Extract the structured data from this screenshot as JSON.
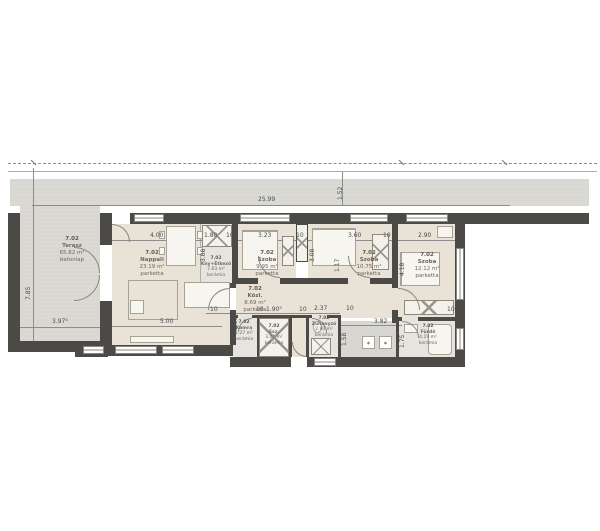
{
  "plan": {
    "unit": "7.02",
    "rooms": [
      {
        "id": "terasz",
        "number": "7.02",
        "name": "Terasz",
        "area": "65.82 m²",
        "floor": "betonlap"
      },
      {
        "id": "nappali",
        "number": "7.02",
        "name": "Nappali",
        "area": "23.19 m²",
        "floor": "parketta"
      },
      {
        "id": "kny",
        "number": "7.02",
        "name": "Kny+Étkező",
        "area": "7.63 m²",
        "floor": "kerámia"
      },
      {
        "id": "szoba1",
        "number": "7.02",
        "name": "Szoba",
        "area": "9.95 m²",
        "floor": "parketta"
      },
      {
        "id": "szoba2",
        "number": "7.02",
        "name": "Szoba",
        "area": "10.75 m²",
        "floor": "parketta"
      },
      {
        "id": "szoba3",
        "number": "7.02",
        "name": "Szoba",
        "area": "12.12 m²",
        "floor": "parketta"
      },
      {
        "id": "kozl",
        "number": "7.02",
        "name": "Közl.",
        "area": "8.69 m²",
        "floor": "parketta"
      },
      {
        "id": "kamra",
        "number": "7.02",
        "name": "Kamra",
        "area": "1.27 m²",
        "floor": "kerámia"
      },
      {
        "id": "esz",
        "number": "7.02",
        "name": "Esz.",
        "area": "3.01 m²",
        "floor": "kerámia"
      },
      {
        "id": "zuhanyzo",
        "number": "7.02",
        "name": "Zuhanyzó",
        "area": "2.90 m²",
        "floor": "kerámia"
      },
      {
        "id": "furdo",
        "number": "7.02",
        "name": "Fürdő",
        "area": "4.19 m²",
        "floor": "kerámia"
      }
    ],
    "dimensions": [
      {
        "id": "total-width",
        "text": "25.99"
      },
      {
        "id": "band-depth",
        "text": "1.52"
      },
      {
        "id": "terrace-depth",
        "text": "7.85"
      },
      {
        "id": "terrace-width",
        "text": "3.97⁵"
      },
      {
        "id": "nappali-width",
        "text": "4.00"
      },
      {
        "id": "kny-width",
        "text": "1.80"
      },
      {
        "id": "wall-10-a",
        "text": "10"
      },
      {
        "id": "szoba1-width",
        "text": "3.23"
      },
      {
        "id": "wall-10-b",
        "text": "10"
      },
      {
        "id": "szoba2-width",
        "text": "3.60"
      },
      {
        "id": "wall-10-c",
        "text": "10"
      },
      {
        "id": "szoba3-width",
        "text": "2.90"
      },
      {
        "id": "kny-depth",
        "text": "3.08"
      },
      {
        "id": "szoba2-depth",
        "text": "3.08"
      },
      {
        "id": "szoba3-depth",
        "text": "4.18"
      },
      {
        "id": "hall-depth",
        "text": "1.17"
      },
      {
        "id": "wall-45",
        "text": "45"
      },
      {
        "id": "nappali-bottom",
        "text": "5.00"
      },
      {
        "id": "nappali-depth",
        "text": "2.86"
      },
      {
        "id": "wall-10-d",
        "text": "10"
      },
      {
        "id": "wall-10-e",
        "text": "10"
      },
      {
        "id": "esz-width",
        "text": "1.90⁵"
      },
      {
        "id": "zuh-width",
        "text": "2.37"
      },
      {
        "id": "zuh-depth",
        "text": "1.58"
      },
      {
        "id": "wall-10-f",
        "text": "10"
      },
      {
        "id": "corridor-width",
        "text": "3.82"
      },
      {
        "id": "corridor-depth",
        "text": "1.75"
      },
      {
        "id": "wall-10-g",
        "text": "10"
      },
      {
        "id": "wall-10-h",
        "text": "10"
      }
    ],
    "colors": {
      "wall": "#4b4a46",
      "walkway": "#dad9d4",
      "parquet": "#e9e2d6",
      "ceramic": "#e6e4df",
      "accent_gray": "#d7d6d1"
    }
  }
}
